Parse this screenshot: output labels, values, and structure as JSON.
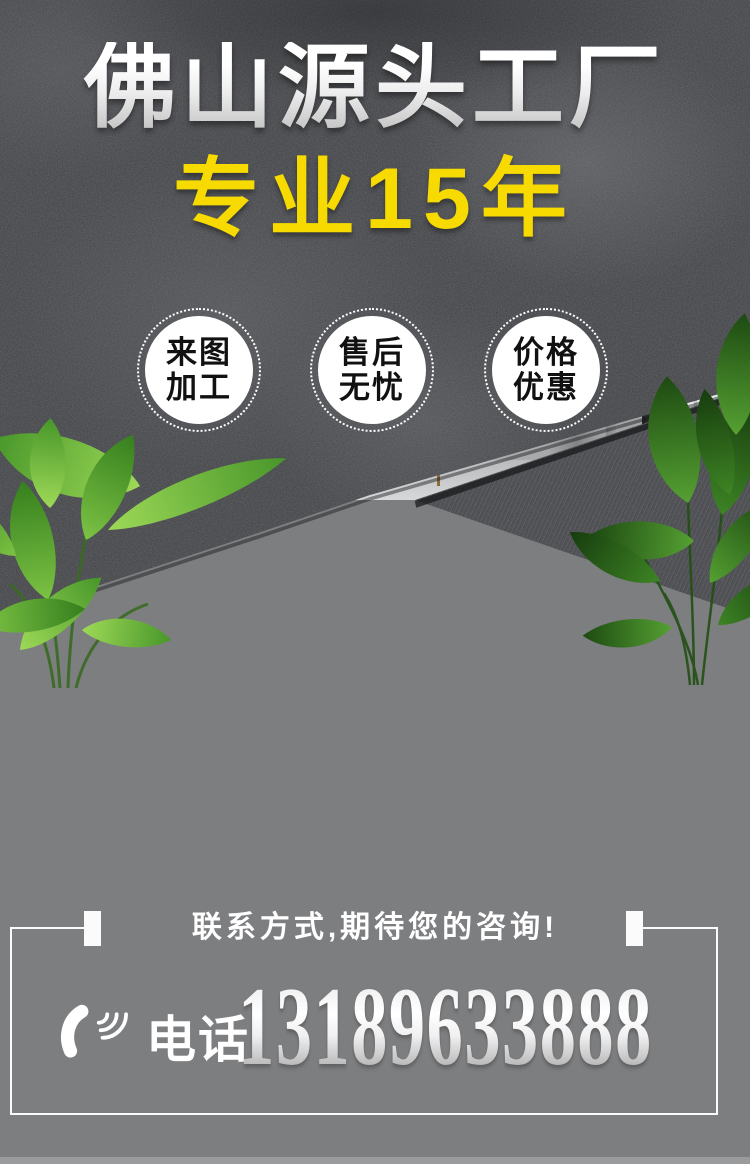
{
  "page": {
    "width": 750,
    "height": 1164
  },
  "banner": {
    "title": "佛山源头工厂",
    "subtitle": "专业15年",
    "badges": [
      {
        "lines": [
          "来图",
          "加工"
        ]
      },
      {
        "lines": [
          "售后",
          "无忧"
        ]
      },
      {
        "lines": [
          "价格",
          "优惠"
        ]
      }
    ]
  },
  "footer": {
    "heading": "联系方式,期待您的咨询!",
    "phone_label": "电话:",
    "phone_number": "13189633888"
  },
  "icons": {
    "phone": "phone-handset-icon"
  },
  "colors": {
    "accent_yellow": "#F7DA00",
    "title_gradient_top": "#FFFFFF",
    "title_gradient_bottom": "#C0C0C0",
    "texture_dark": "#3E4043",
    "texture_weave": "#46484C",
    "footer_gray": "#7D7E80",
    "frame_white": "#FBFBFB",
    "badge_text": "#111111",
    "gold_faucet": "#B08D4F",
    "plant_green_light": "#6FBE3A",
    "plant_green_dark": "#2F6B1C",
    "led_glow": "#FFFFFF"
  }
}
